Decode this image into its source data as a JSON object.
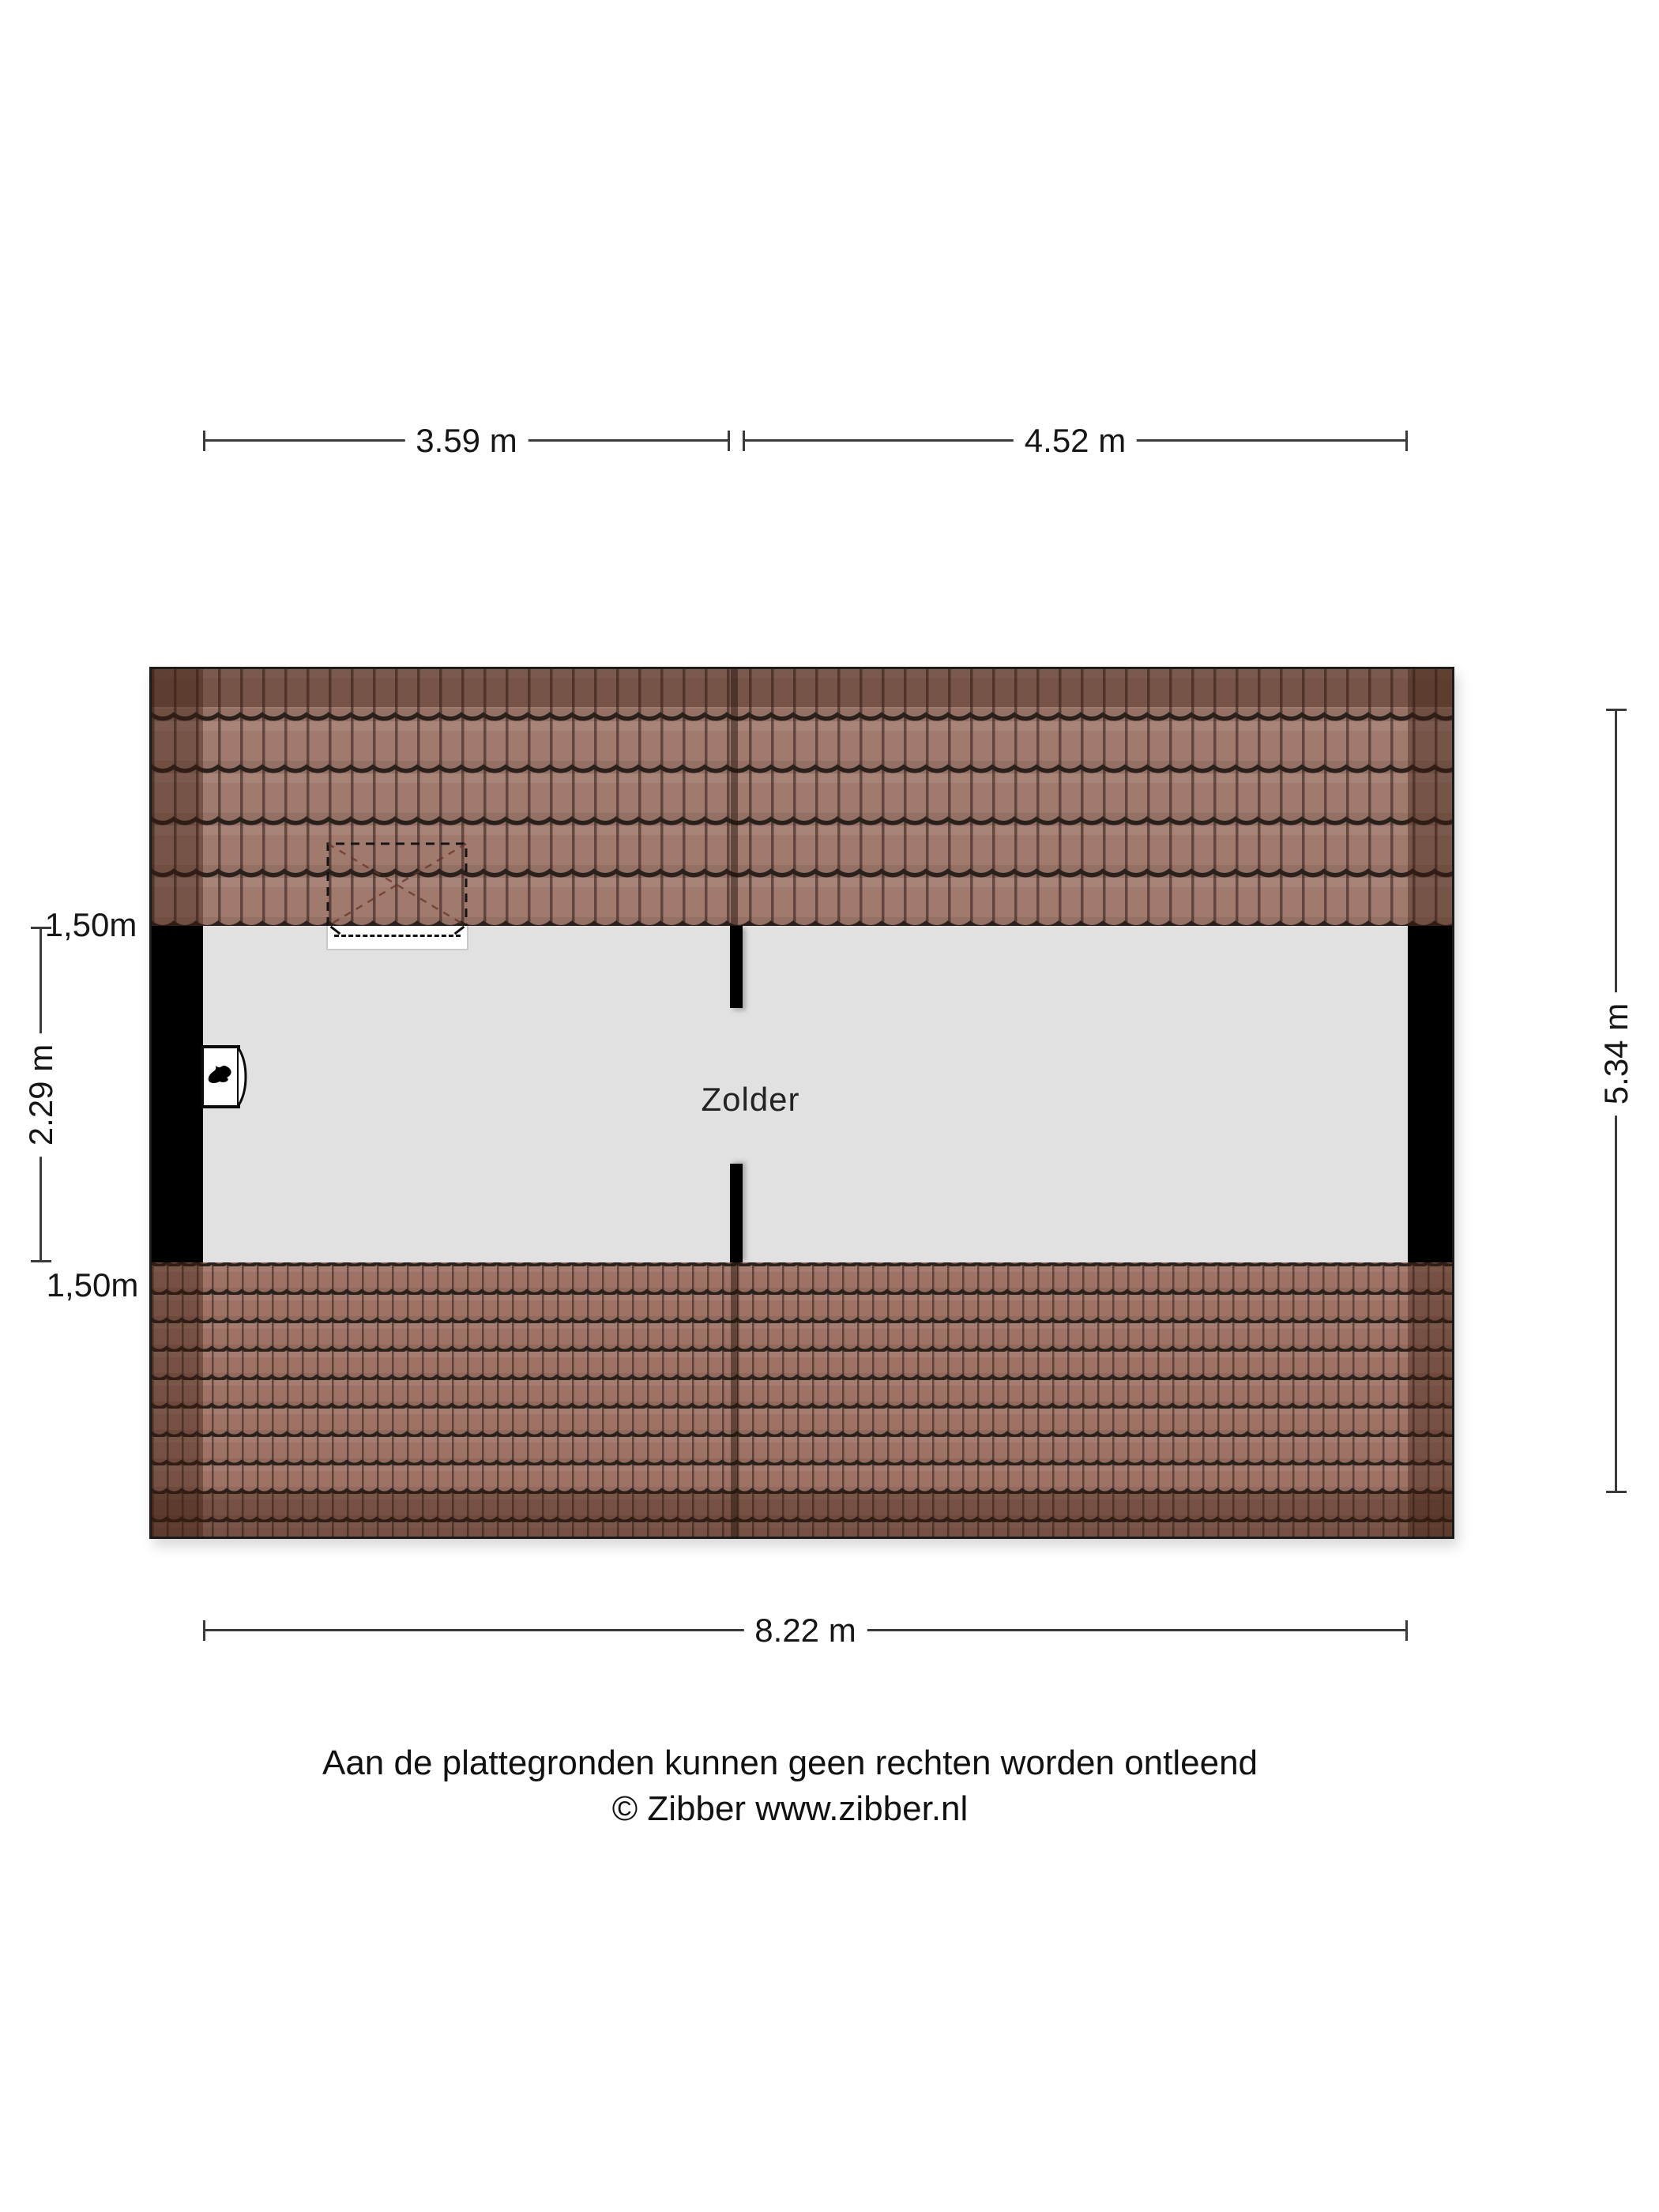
{
  "plan": {
    "room_label": "Zolder",
    "features": {
      "boiler_icon": "flame-icon",
      "skylight": "dashed roof-window outline with white sill"
    }
  },
  "dimensions": {
    "top_left_width": "3.59 m",
    "top_right_width": "4.52 m",
    "total_width": "8.22 m",
    "left_slope_top": "1,50m",
    "interior_depth": "2.29 m",
    "left_slope_bottom": "1,50m",
    "total_depth": "5.34 m"
  },
  "footer": {
    "line1": "Aan de plattegronden kunnen geen rechten worden ontleend",
    "line2": "© Zibber www.zibber.nl"
  },
  "colors": {
    "wall": "#000000",
    "interior": "#e2e1e1",
    "tile-top": "#a17a6e",
    "tile-bottom": "#9e7365",
    "roof-shade": "#3a1c0e",
    "line": "#3b3b3b",
    "text": "#161616"
  }
}
